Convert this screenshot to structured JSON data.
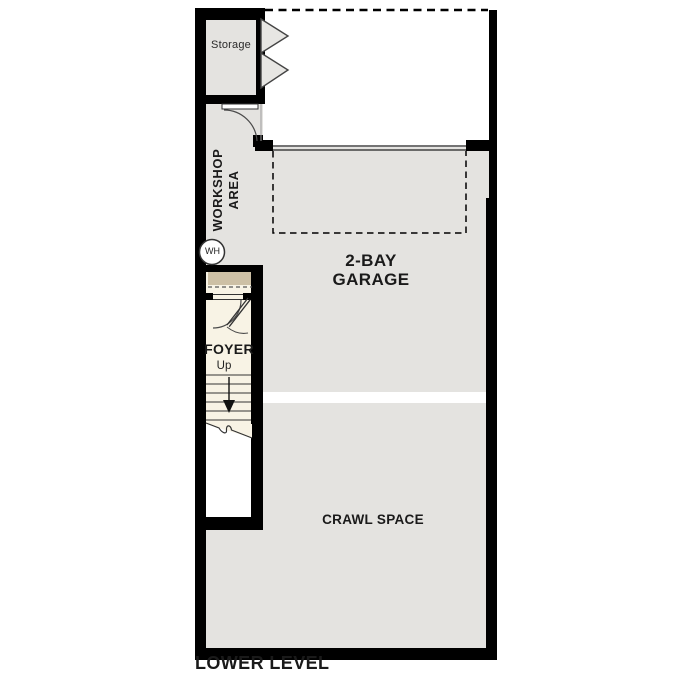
{
  "plan_title": "LOWER LEVEL",
  "rooms": {
    "storage": {
      "label": "Storage"
    },
    "workshop": {
      "line1": "WORKSHOP",
      "line2": "AREA"
    },
    "garage": {
      "line1": "2-BAY",
      "line2": "GARAGE"
    },
    "foyer": {
      "label": "FOYER"
    },
    "stairs": {
      "up_label": "Up"
    },
    "crawl_space": {
      "label": "CRAWL SPACE"
    },
    "water_heater": {
      "label": "WH"
    }
  },
  "colors": {
    "wall": "#000000",
    "room_fill": "#e4e3e0",
    "foyer_fill": "#f8f3e5",
    "landing_fill": "#cdc0a5",
    "line": "#3a3a3a",
    "door_line": "#4a4a4a",
    "text": "#1a1a1a"
  }
}
